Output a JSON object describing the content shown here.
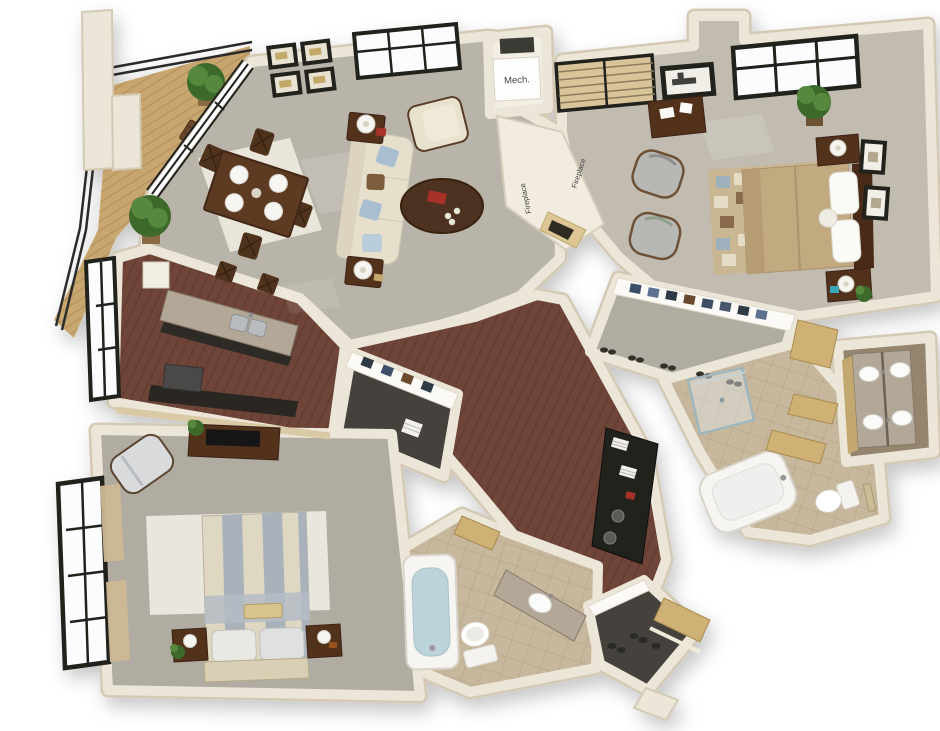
{
  "image": {
    "type": "3d-isometric-floor-plan-rendering",
    "background": "#ffffff",
    "description-of-pixels": "two-bedroom two-bath apartment 3D floor plan viewed from above at an angle"
  },
  "labels": {
    "mech": "Mech.",
    "fireplace_a": "Fireplace",
    "fireplace_b": "Fireplace"
  },
  "palette": {
    "wall": "#ece6d8",
    "wallShadow": "#d3c9b5",
    "carpet": "#b9b4a9",
    "carpet2": "#c2bcb0",
    "carpet3": "#b1aca1",
    "wood": "#6e4437",
    "woodLine": "#57332a",
    "deck": "#c8a66f",
    "deckLine": "#a8854e",
    "tile": "#c7b79c",
    "tileLine": "#b1a084",
    "darkFloor": "#45423c",
    "brownFloor": "#96856e",
    "granite": "#b3a898",
    "graniteDark": "#857a69",
    "sofa": "#e6dfcc",
    "woodFurn": "#53321f",
    "bedTan": "#c2aa80",
    "gold": "#cfb176",
    "water": "#bdd3da",
    "plant": "#56883c",
    "plantDark": "#3c6b2a",
    "frame": "#20201e",
    "glass": "#fbfcfd",
    "textColor": "#454542",
    "fixture": "#f5f4f0",
    "chairGray": "#b7b8b4",
    "duvetGray": "#a9b2bb",
    "duvetCream": "#ded7c2",
    "red": "#a8322c",
    "navy": "#3c4f66",
    "steel": "#b9bcbe"
  },
  "regions": [
    "balcony",
    "great-room",
    "dining-area",
    "living-area",
    "kitchen",
    "hallway",
    "mechanical-closet",
    "double-sided-fireplace",
    "master-bedroom",
    "master-walk-in-closet",
    "master-bathroom",
    "vanity-room",
    "toilet-room",
    "laundry-closet",
    "bedroom-2",
    "bedroom-2-closet",
    "bathroom-2",
    "entry",
    "entry-closet"
  ],
  "furniture": [
    "dining-table",
    "dining-chairs",
    "area-rug",
    "sofa",
    "coffee-table",
    "armchair",
    "end-tables-with-lamps",
    "wall-art-frames",
    "kitchen-island-with-double-sink",
    "bar-stools",
    "bed-master",
    "nightstands",
    "patchwork-rug",
    "accent-chairs",
    "desk",
    "window-plants",
    "double-vanity-sinks",
    "soaking-tub",
    "glass-shower",
    "toilets",
    "stacked-laundry-shelves",
    "bed-2-striped",
    "media-console-tv",
    "chaise",
    "bathtub",
    "vanity-sink",
    "open-doors",
    "balcony-bench",
    "railing"
  ]
}
